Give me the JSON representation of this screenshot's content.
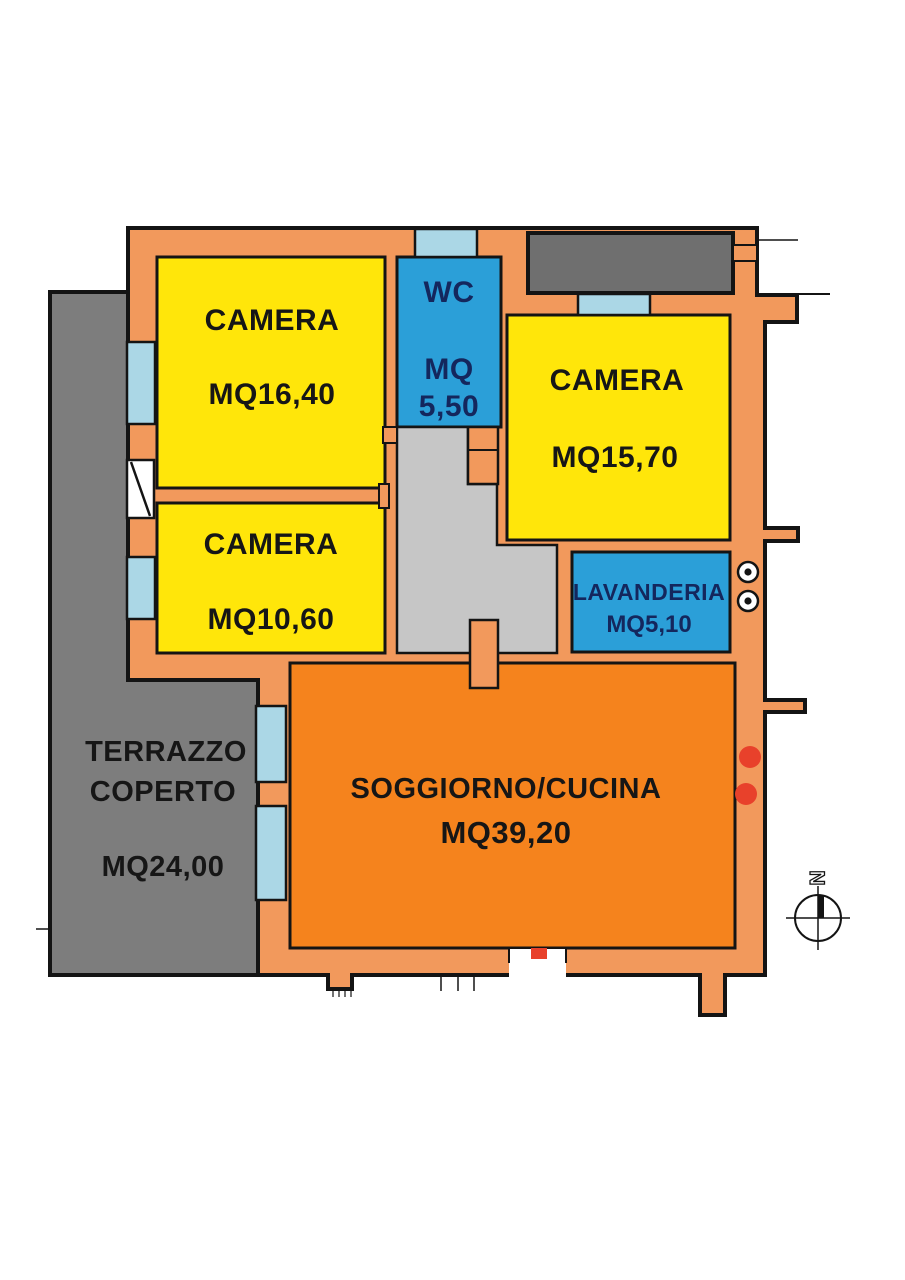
{
  "rooms": {
    "camera_nw": {
      "label": "CAMERA",
      "area": "MQ16,40"
    },
    "wc": {
      "label": "WC",
      "area_line1": "MQ",
      "area_line2": "5,50"
    },
    "camera_ne": {
      "label": "CAMERA",
      "area": "MQ15,70"
    },
    "camera_w": {
      "label": "CAMERA",
      "area": "MQ10,60"
    },
    "lavanderia": {
      "label": "LAVANDERIA",
      "area": "MQ5,10"
    },
    "soggiorno_cucina": {
      "label": "SOGGIORNO/CUCINA",
      "area": "MQ39,20"
    },
    "terrazzo_coperto": {
      "label_line1": "TERRAZZO",
      "label_line2": "COPERTO",
      "area": "MQ24,00"
    }
  },
  "compass": {
    "north_label": "N"
  },
  "colors": {
    "wall_orange": "#f2995c",
    "room_yellow": "#ffe60a",
    "room_blue": "#2b9fd8",
    "living_orange": "#f5831d",
    "terrace_gray": "#7d7d7d",
    "neighbor_gray": "#6f6f6f",
    "corridor_gray": "#c6c6c6",
    "window_blue": "#abd7e6",
    "marker_red": "#e8412b",
    "door_white": "#ffffff",
    "label_navy": "#14275d",
    "line_black": "#141414"
  }
}
